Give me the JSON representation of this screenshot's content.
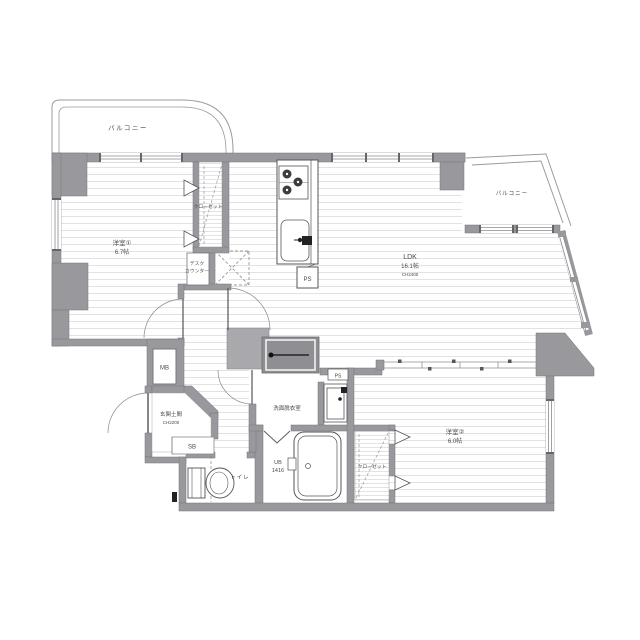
{
  "plan_type": "floor-plan",
  "rooms": {
    "balcony1": "バルコニー",
    "balcony2": "バルコニー",
    "room1_name": "洋室①",
    "room1_size": "6.7帖",
    "closet1": "クローゼット",
    "desk_line1": "デスク",
    "desk_line2": "カウンター",
    "ldk_name": "LDK",
    "ldk_size": "16.1帖",
    "ldk_ch": "CH2400",
    "ps_kitchen": "PS",
    "mb": "MB",
    "genkan_name": "玄関土間",
    "genkan_ch": "CH2200",
    "sb": "SB",
    "toilet": "トイレ",
    "washroom": "洗面脱衣室",
    "ps_washroom": "PS",
    "ub_name": "UB",
    "ub_size": "1416",
    "closet2": "クローゼット",
    "room2_name": "洋室②",
    "room2_size": "6.0帖"
  },
  "colors": {
    "wall": "#98989d",
    "wall_edge": "#77777d",
    "floor_line": "#e2e2e2",
    "fixture": "#555555",
    "text": "#4a4a4a"
  }
}
